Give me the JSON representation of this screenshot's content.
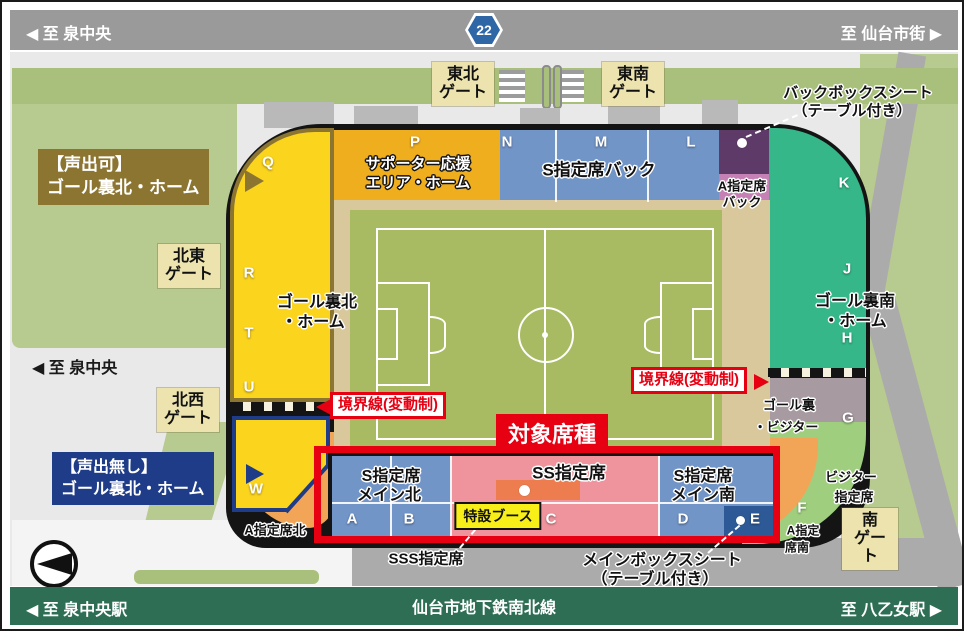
{
  "top_bar": {
    "left_label": "至 泉中央",
    "route_number": "22",
    "right_label": "至 仙台市街"
  },
  "mid_left_road_label": "至 泉中央",
  "bottom_bar": {
    "left_label": "至 泉中央駅",
    "center_label": "仙台市地下鉄南北線",
    "right_label": "至 八乙女駅"
  },
  "icons": {
    "arrow_left": "◀",
    "arrow_right": "▶"
  },
  "gates": {
    "tohoku": {
      "line1": "東北",
      "line2": "ゲート"
    },
    "tonan": {
      "line1": "東南",
      "line2": "ゲート"
    },
    "hokuto": {
      "line1": "北東",
      "line2": "ゲート"
    },
    "hokusei": {
      "line1": "北西",
      "line2": "ゲート"
    },
    "minami": {
      "line1": "南",
      "line2": "ゲート"
    }
  },
  "legend": {
    "voice_ok": {
      "line1": "【声出可】",
      "line2": "ゴール裏北・ホーム"
    },
    "voice_no": {
      "line1": "【声出無し】",
      "line2": "ゴール裏北・ホーム"
    }
  },
  "boundary_label": "境界線(変動制)",
  "target_banner": "対象席種",
  "sections": {
    "supporter_area": {
      "line1": "サポーター応援",
      "line2": "エリア・ホーム"
    },
    "s_shitei_back": {
      "label": "S指定席バック"
    },
    "a_shitei_back": {
      "line1": "A指定席",
      "line2": "バック"
    },
    "back_box_seat": {
      "line1": "バックボックスシート",
      "line2": "（テーブル付き）"
    },
    "goal_ura_north": {
      "line1": "ゴール裏北",
      "line2": "・ホーム"
    },
    "goal_ura_south": {
      "line1": "ゴール裏南",
      "line2": "・ホーム"
    },
    "goal_ura_visitor": {
      "line1": "ゴール裏",
      "line2": "・ビジター"
    },
    "visitor_shitei": {
      "line1": "ビジター",
      "line2": "指定席"
    },
    "a_shitei_south": {
      "line1": "A指定",
      "line2": "席南"
    },
    "a_shitei_north": {
      "label": "A指定席北"
    },
    "s_main_north": {
      "line1": "S指定席",
      "line2": "メイン北"
    },
    "ss_shitei": {
      "label": "SS指定席"
    },
    "s_main_south": {
      "line1": "S指定席",
      "line2": "メイン南"
    },
    "sss_shitei": {
      "label": "SSS指定席"
    },
    "main_box_seat": {
      "line1": "メインボックスシート",
      "line2": "（テーブル付き）"
    },
    "tokusetsu_booth": {
      "label": "特設ブース"
    }
  },
  "letters": {
    "p": "P",
    "n": "N",
    "m": "M",
    "l": "L",
    "k": "K",
    "q": "Q",
    "r": "R",
    "t": "T",
    "u": "U",
    "w": "W",
    "j": "J",
    "h": "H",
    "g": "G",
    "f": "F",
    "a": "A",
    "b": "B",
    "c": "C",
    "d": "D",
    "e": "E"
  },
  "colors": {
    "top_bar": "#9a9a9a",
    "bottom_bar": "#2e6e55",
    "route_badge": "#2f66a5",
    "yellow_stand": "#fbd41e",
    "supporter_orange": "#efae1e",
    "blue_stand": "#7295c8",
    "dark_blue_block": "#2d5a96",
    "purple_box": "#5e3a68",
    "pink_back": "#c581b4",
    "teal_stand": "#35b78a",
    "visitor_gray": "#a79aa0",
    "orange_stand": "#f2a556",
    "ss_pink": "#ef949d",
    "booth_orange": "#ed7d4e",
    "track_tan": "#d9c89c",
    "pitch_green": "#a8bb62",
    "park_green": "#b7ca8f",
    "accent_red": "#e60012",
    "voice_ok_brown": "#8c7531",
    "voice_no_navy": "#1e3c87",
    "gate_cream": "#ece3ae",
    "booth_yellow": "#f8ef19"
  }
}
